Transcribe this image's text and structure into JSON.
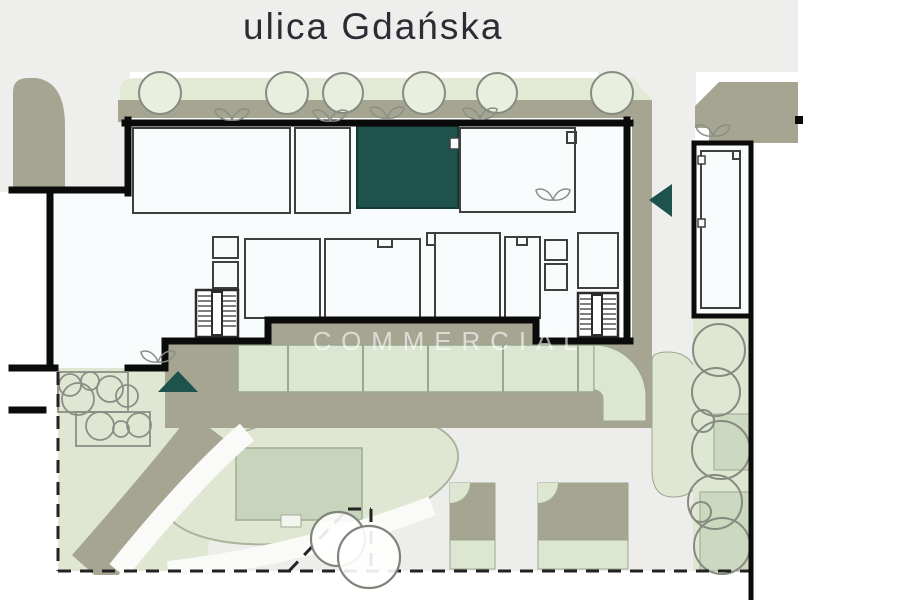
{
  "street": {
    "label": "ulica Gdańska"
  },
  "watermark": {
    "text": "COMMERCIAL"
  },
  "colors": {
    "highlight_unit": "#1e524c",
    "entrance_marker": "#1e524c",
    "landscape_green": "#dfe7d3",
    "tree_fill_green": "#e9efdf",
    "parking_green": "#dde6d1",
    "path_olive": "#a5a592",
    "street_gray": "#eeeeec",
    "court_gray": "#ededeb",
    "building_white": "#f9fcfc",
    "label_text": "#2b2d35"
  },
  "features": {
    "street_tree_count": 6,
    "entrance_marker_count": 2,
    "top_parking_stall_count": 6,
    "bottom_parking_stall_count": 2,
    "stairwell_count": 2,
    "highlighted_unit_count": 1
  }
}
